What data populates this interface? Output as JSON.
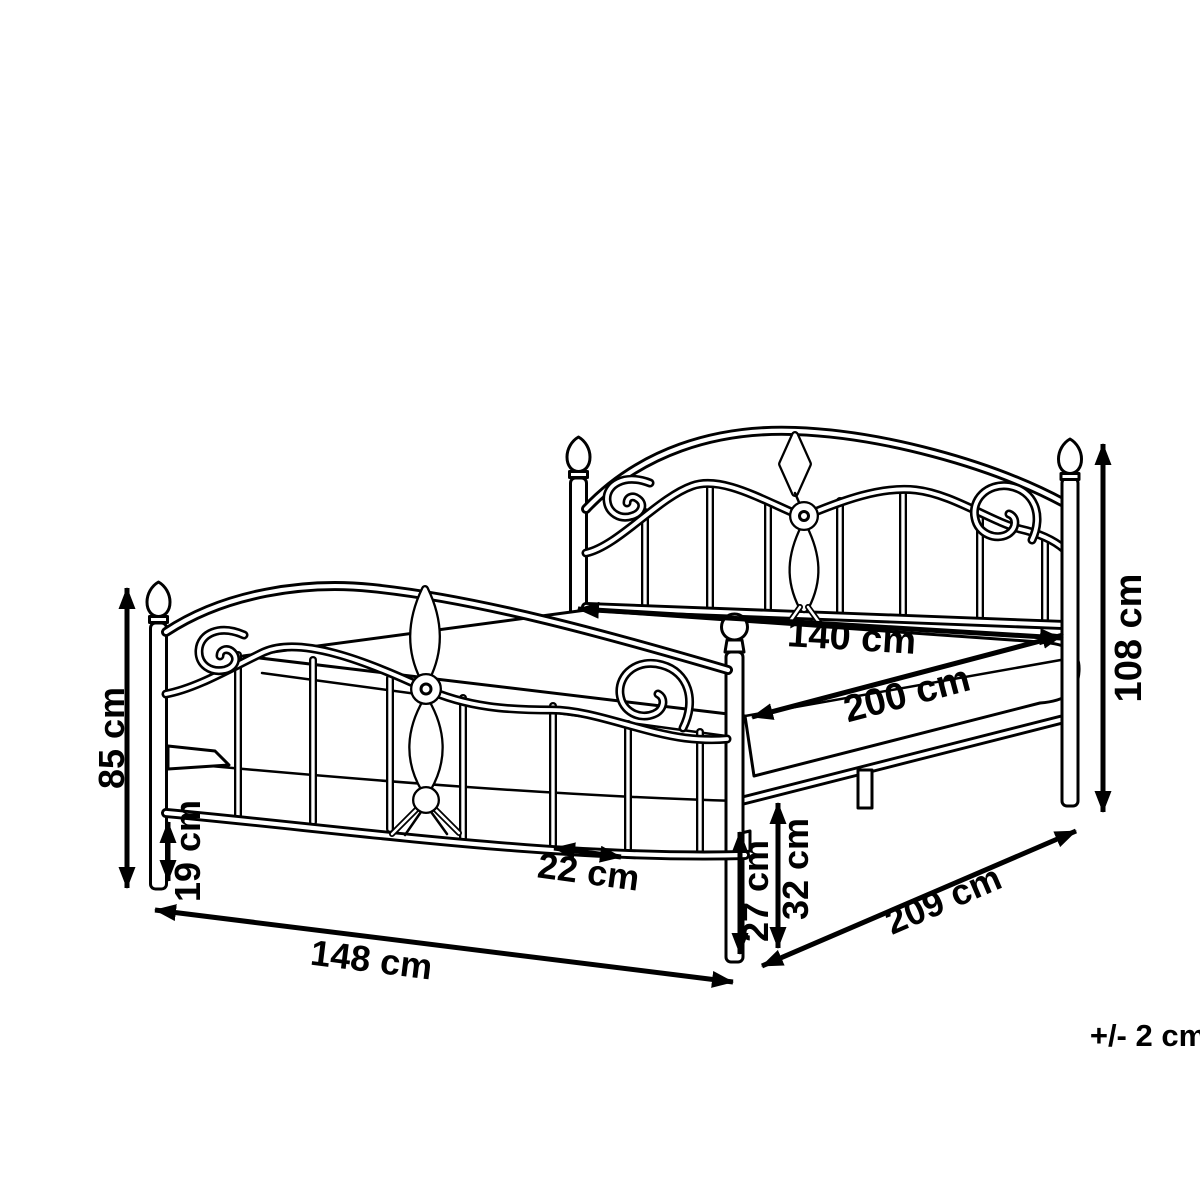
{
  "diagram": {
    "background": "#ffffff",
    "line_color": "#000000",
    "dimensions": {
      "headboard_width": "140 cm",
      "length": "200 cm",
      "headboard_height": "108 cm",
      "footboard_height": "85 cm",
      "ground_clearance": "19 cm",
      "slat_gap": "22 cm",
      "rail_clearance": "27 cm",
      "frame_height": "32 cm",
      "footboard_width": "148 cm",
      "overall_length": "209 cm"
    },
    "tolerance_note": "+/- 2 cm"
  }
}
